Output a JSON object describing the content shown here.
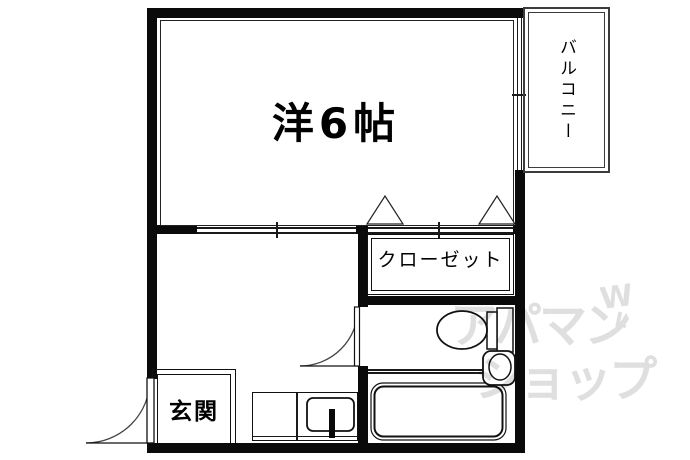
{
  "floorplan": {
    "rooms": {
      "main_room": {
        "label": "洋6帖"
      },
      "balcony": {
        "label": "バルコニー"
      },
      "closet": {
        "label": "クローゼット"
      },
      "entrance": {
        "label": "玄関"
      }
    },
    "fixtures": {
      "toilet": "toilet",
      "bathtub": "bathtub",
      "wash_basin": "wash-basin",
      "kitchen_sink": "kitchen-sink"
    },
    "watermark": {
      "line1": "アパマン",
      "line2": "ショップ",
      "mark_top": "W",
      "mark_bottom": "L",
      "color": "#dfdfdf"
    },
    "colors": {
      "wall": "#0a0a0a",
      "line": "#1a1a1a",
      "background": "#ffffff"
    }
  }
}
